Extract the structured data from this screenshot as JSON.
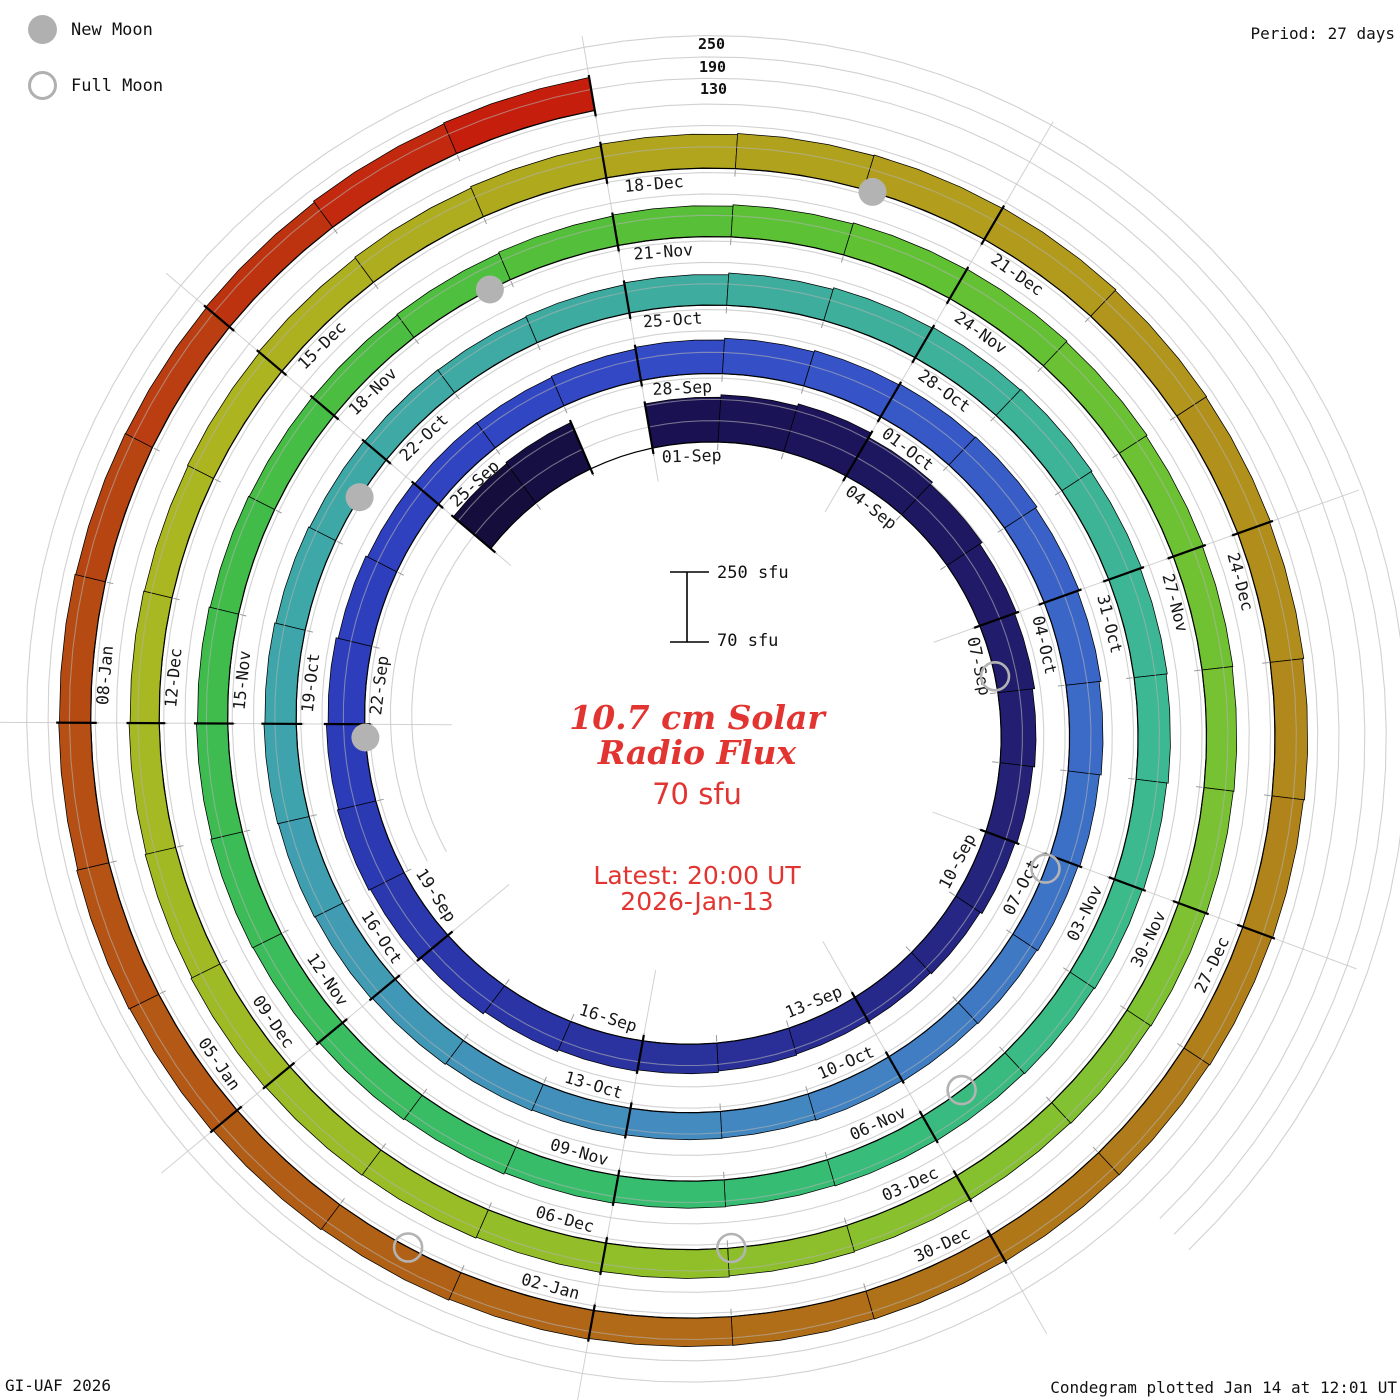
{
  "legend": {
    "new_moon_label": "New Moon",
    "full_moon_label": "Full Moon"
  },
  "period_label": "Period: 27 days",
  "radial_axis_labels": [
    "250",
    "190",
    "130"
  ],
  "scalebar": {
    "top_label": "250 sfu",
    "bottom_label": "70 sfu"
  },
  "center": {
    "title_line1": "10.7 cm Solar",
    "title_line2": "Radio Flux",
    "baseline_label": "70 sfu",
    "latest_line1": "Latest: 20:00 UT",
    "latest_line2": "2026-Jan-13"
  },
  "footer": {
    "credit": "GI-UAF 2026",
    "caption": "Condegram plotted Jan 14 at 12:01 UT"
  },
  "colors": {
    "text_red": "#e23430",
    "moon_gray": "#b3b3b3",
    "gridline": "#b2b2b2",
    "spoke": "#c6c6c6",
    "day_tick": "#9a9a9a",
    "label_text": "#161616",
    "colormap_anchors": [
      [
        -3,
        "#140e38"
      ],
      [
        0,
        "#181050"
      ],
      [
        7,
        "#221d6e"
      ],
      [
        14,
        "#293099"
      ],
      [
        21,
        "#2c3cba"
      ],
      [
        27,
        "#3349c6"
      ],
      [
        34,
        "#3a68c8"
      ],
      [
        41,
        "#4489c0"
      ],
      [
        48,
        "#3ea5ab"
      ],
      [
        55,
        "#3eac9e"
      ],
      [
        62,
        "#3cb992"
      ],
      [
        69,
        "#36bd6c"
      ],
      [
        76,
        "#40bc4a"
      ],
      [
        83,
        "#5ec133"
      ],
      [
        90,
        "#7cc233"
      ],
      [
        97,
        "#96be28"
      ],
      [
        104,
        "#abb620"
      ],
      [
        111,
        "#b29c1c"
      ],
      [
        118,
        "#b07d1a"
      ],
      [
        125,
        "#b15f16"
      ],
      [
        131,
        "#b84312"
      ],
      [
        135,
        "#c8190b"
      ]
    ]
  },
  "chart_data": {
    "type": "bar",
    "layout": "spiral-condegram, one turn = 27 days, time runs clockwise from top, radius grows outward",
    "title": "10.7 cm Solar Radio Flux",
    "period_days": 27,
    "flux_baseline_sfu": 70,
    "flux_axis_max_sfu": 250,
    "radial_gridlines_sfu": [
      130,
      190,
      250
    ],
    "start_date": "2025-08-29",
    "end_date": "2026-01-13",
    "missing_dates": [
      "2025-08-31"
    ],
    "date_labels_every_3_days": [
      "01-Sep",
      "04-Sep",
      "07-Sep",
      "10-Sep",
      "13-Sep",
      "16-Sep",
      "19-Sep",
      "22-Sep",
      "25-Sep",
      "28-Sep",
      "01-Oct",
      "04-Oct",
      "07-Oct",
      "10-Oct",
      "13-Oct",
      "16-Oct",
      "19-Oct",
      "22-Oct",
      "25-Oct",
      "28-Oct",
      "31-Oct",
      "03-Nov",
      "06-Nov",
      "09-Nov",
      "12-Nov",
      "15-Nov",
      "18-Nov",
      "21-Nov",
      "24-Nov",
      "27-Nov",
      "30-Nov",
      "03-Dec",
      "06-Dec",
      "09-Dec",
      "12-Dec",
      "15-Dec",
      "18-Dec",
      "21-Dec",
      "24-Dec",
      "27-Dec",
      "30-Dec",
      "02-Jan",
      "05-Jan",
      "08-Jan"
    ],
    "daily_flux_sfu_from_2025_08_29": [
      208,
      212,
      null,
      196,
      203,
      210,
      196,
      188,
      180,
      174,
      168,
      163,
      158,
      152,
      148,
      146,
      149,
      153,
      157,
      162,
      169,
      176,
      181,
      178,
      173,
      167,
      162,
      158,
      157,
      160,
      165,
      170,
      174,
      177,
      179,
      174,
      169,
      164,
      159,
      154,
      151,
      149,
      147,
      145,
      146,
      149,
      151,
      154,
      157,
      159,
      161,
      158,
      155,
      152,
      150,
      149,
      151,
      156,
      161,
      166,
      169,
      171,
      168,
      164,
      161,
      157,
      154,
      151,
      149,
      147,
      145,
      146,
      149,
      153,
      156,
      159,
      161,
      158,
      155,
      152,
      150,
      149,
      151,
      154,
      157,
      161,
      164,
      166,
      163,
      160,
      157,
      155,
      153,
      151,
      149,
      147,
      146,
      148,
      151,
      154,
      157,
      159,
      161,
      158,
      155,
      152,
      150,
      152,
      155,
      158,
      162,
      166,
      169,
      171,
      173,
      170,
      168,
      165,
      162,
      159,
      157,
      155,
      154,
      152,
      151,
      150,
      152,
      155,
      158,
      161,
      163,
      160,
      158,
      156,
      155,
      157,
      161,
      164
    ],
    "new_moons": [
      {
        "date": "2025-09-21",
        "day_offset": 20.83
      },
      {
        "date": "2025-10-21",
        "day_offset": 50.52
      },
      {
        "date": "2025-11-20",
        "day_offset": 79.8
      },
      {
        "date": "2025-12-20",
        "day_offset": 110.07
      }
    ],
    "full_moons": [
      {
        "date": "2025-09-07",
        "day_offset": 6.76
      },
      {
        "date": "2025-10-07",
        "day_offset": 36.16
      },
      {
        "date": "2025-11-05",
        "day_offset": 65.55
      },
      {
        "date": "2025-12-04",
        "day_offset": 94.97
      },
      {
        "date": "2026-01-03",
        "day_offset": 124.42
      }
    ]
  }
}
